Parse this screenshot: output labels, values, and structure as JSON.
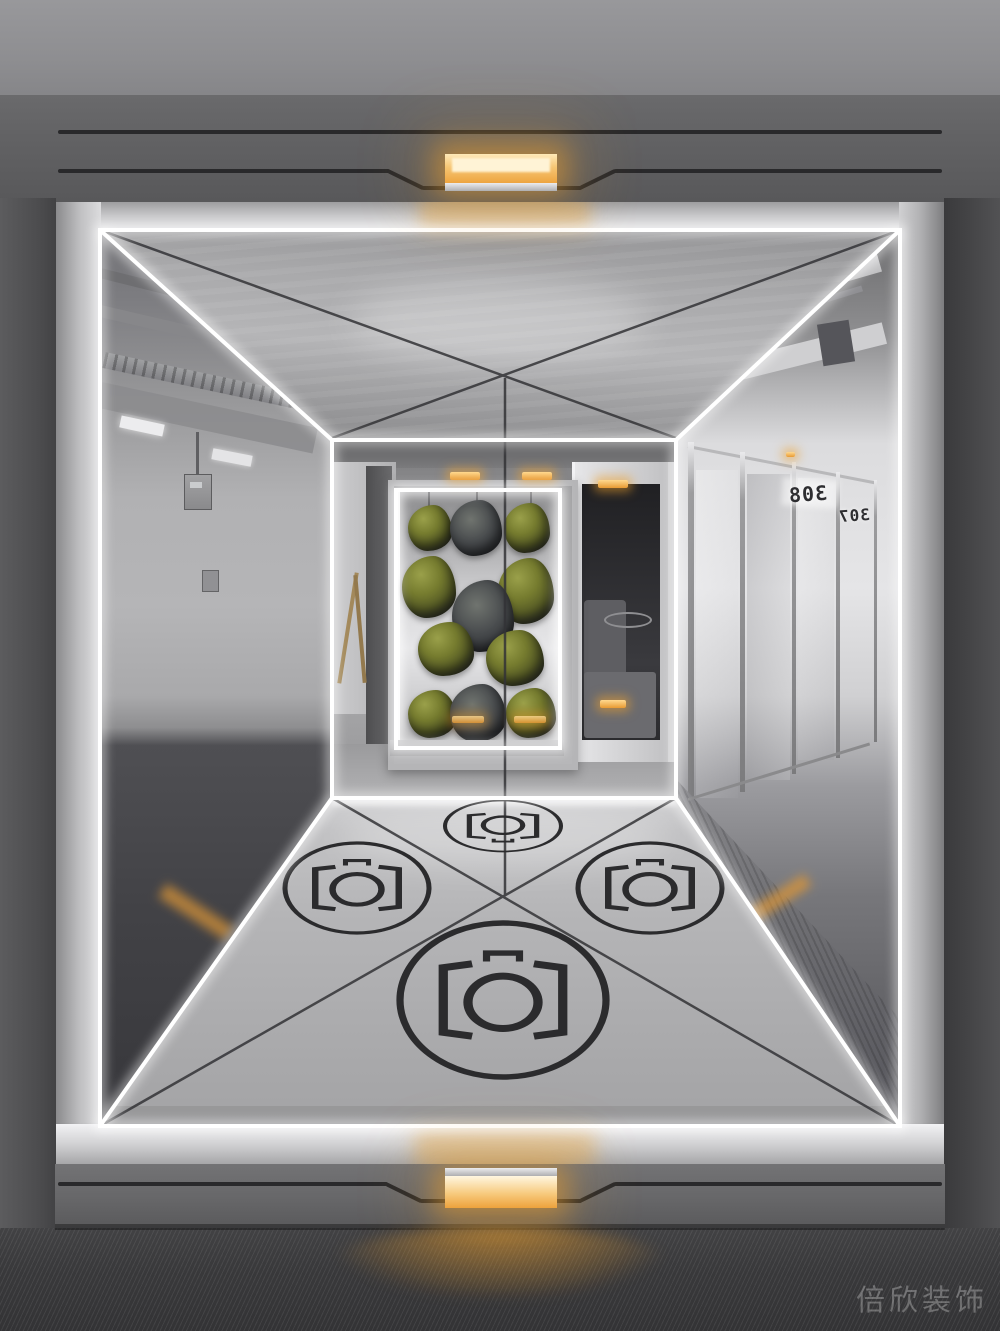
{
  "scene": {
    "type": "interior-photograph",
    "description": "Mirrored futuristic photo room: LED-edged cube opening with hanging moss sculpture display, camera icons etched on a metal floor, amber accent lights top and bottom, glass office hallway on the right"
  },
  "signs": {
    "room_back": "308",
    "room_front": "307"
  },
  "watermark": {
    "text": "倍欣装饰"
  },
  "floor_icons": {
    "glyph": "camera-in-circle",
    "count": 4
  },
  "colors": {
    "amber_light": "#eda23c",
    "led_white": "#ffffff",
    "metal_frame": "#c6c6c8",
    "dark_wall": "#4a4a4c",
    "moss_green": "#6b7030",
    "rock_gray": "#3f4145",
    "floor_icon_ink": "#2b2b2d",
    "carpet": "#39393b"
  }
}
